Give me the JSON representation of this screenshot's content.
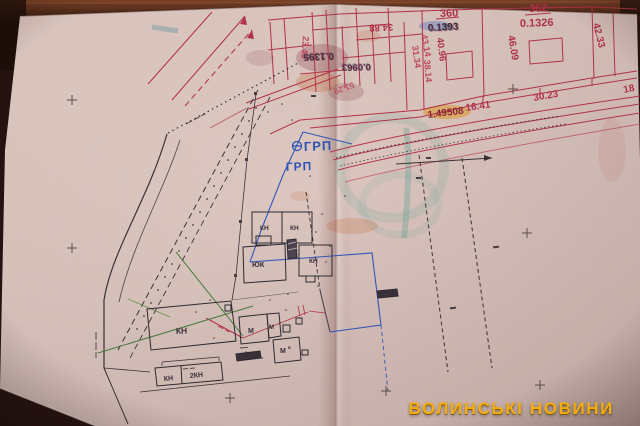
{
  "watermark": {
    "text": "ВОЛИНСЬКІ НОВИНИ",
    "color": "#f2ac14"
  },
  "parcels": {
    "p360": {
      "number": "360",
      "area": "0.1393"
    },
    "p362": {
      "number": "362",
      "area": "0.1326"
    }
  },
  "dimensions": {
    "d46_09": "46.09",
    "d42_33": "42.33",
    "d40_96": "40.96",
    "d43_14": "43.14",
    "d31_34": "31.34",
    "d38_14": "38.14",
    "d16_41": "16.41",
    "d30_23": "30.23",
    "d18": "18",
    "d34_88": "34.88",
    "d23_49": "23.49",
    "d51_29": "51.29",
    "a0_1395": "0.1395",
    "a0_0963": "0.0963",
    "d1_49508": "1.49508"
  },
  "annotations": {
    "grp_top": "ГРП",
    "grp_bottom": "ГРП"
  },
  "buildings": {
    "kn": "КН",
    "yuk": "ЮК",
    "m": "М",
    "m_sup": "в",
    "kn2": "2КН"
  },
  "colors": {
    "cadastral_red": "#b5344a",
    "ink_black": "#3b3238",
    "marker_blue": "#2f55b5",
    "survey_green": "#4a7d3c",
    "stain_teal": "#57a693",
    "paper": "#dcc6c0",
    "table_wood": "#52291a"
  }
}
